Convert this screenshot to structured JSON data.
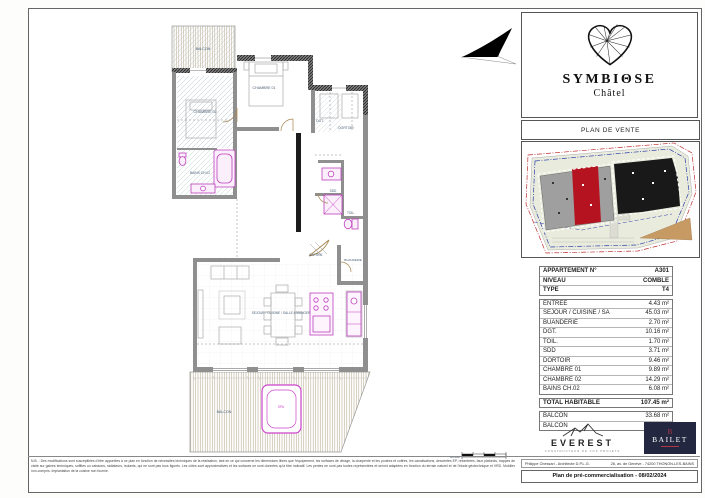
{
  "brand": {
    "name": "SYMBIΘSE",
    "sub": "Châtel",
    "plan_type": "PLAN DE VENTE"
  },
  "table": {
    "header": [
      {
        "label": "APPARTEMENT N°",
        "value": "A301"
      },
      {
        "label": "NIVEAU",
        "value": "COMBLE"
      },
      {
        "label": "TYPE",
        "value": "T4"
      }
    ],
    "rooms": [
      {
        "label": "ENTREE",
        "value": "4.43 m²"
      },
      {
        "label": "SEJOUR / CUISINE / SA",
        "value": "45.03 m²"
      },
      {
        "label": "BUANDERIE",
        "value": "2.70 m²"
      },
      {
        "label": "DGT.",
        "value": "10.16 m²"
      },
      {
        "label": "TOIL.",
        "value": "1.70 m²"
      },
      {
        "label": "SDD",
        "value": "3.71 m²"
      },
      {
        "label": "DORTOIR",
        "value": "9.46 m²"
      },
      {
        "label": "CHAMBRE 01",
        "value": "9.89 m²"
      },
      {
        "label": "CHAMBRE 02",
        "value": "14.29 m²"
      },
      {
        "label": "BAINS CH.02",
        "value": "6.08 m²"
      }
    ],
    "total": {
      "label": "TOTAL HABITABLE",
      "value": "107.45 m²"
    },
    "balconies": [
      {
        "label": "BALCON",
        "value": "33.68 m²"
      },
      {
        "label": "BALCON",
        "value": "6.10 m²"
      }
    ]
  },
  "plan": {
    "labels": {
      "balcon_top": "BALCON",
      "chambre02": "CHAMBRE 02",
      "bains": "BAINS CH.02",
      "chambre01": "CHAMBRE 01",
      "dgt": "DGT.",
      "dortoir": "DORTOIR",
      "sdd": "SDD",
      "toil": "TOIL.",
      "entree": "ENTREE",
      "buanderie": "BUANDERIE",
      "sejour": "SEJOUR / CUISINE / SALLE A MANGER",
      "balcon_bottom": "BALCON",
      "spa": "SPA",
      "echelle": "Echelle"
    }
  },
  "footer": {
    "everest": {
      "name": "EVEREST",
      "tagline": "CONSTRUCTEUR DE VOS PROJETS"
    },
    "bailet": {
      "monogram": "B",
      "name": "BAILET"
    },
    "architect": "Philippe Chessari - Architecte D.P.L.G.",
    "address": "26, av. de Genève - 74200 THONON-LES-BAINS",
    "plan_title": "Plan de pré-commercialisation - 08/02/2024"
  },
  "disclaimer": {
    "line1": "N.B. : Des modifications sont susceptibles d'être apportées à ce plan en fonction de nécessités techniques de la réalisation, tant en ce qui concerne les dimensions libres que l'équipement, les surfaces de vitrage, la charpente et les poutres et coffres, les canalisations,",
    "line2": "descentes EP, retombées, faux plafonds, trappes de visite sur gaines techniques, soffites ou caissons, radiateurs, isolants, qui ne sont pas tous figurés. Les côtes sont approximatives et les surfaces ne sont données qu'à titre",
    "line3": "indicatif. Les pentes ne sont pas toutes représentées et seront adaptées en fonction du terrain naturel et de l'étude géotechnique et VRD. Mobilier non-compris. Implantation de la cuisine non fournie."
  },
  "colors": {
    "accent_pink": "#bf3fbf",
    "bailet_navy": "#232840",
    "bailet_red": "#b03545",
    "site_red": "#b51320"
  }
}
